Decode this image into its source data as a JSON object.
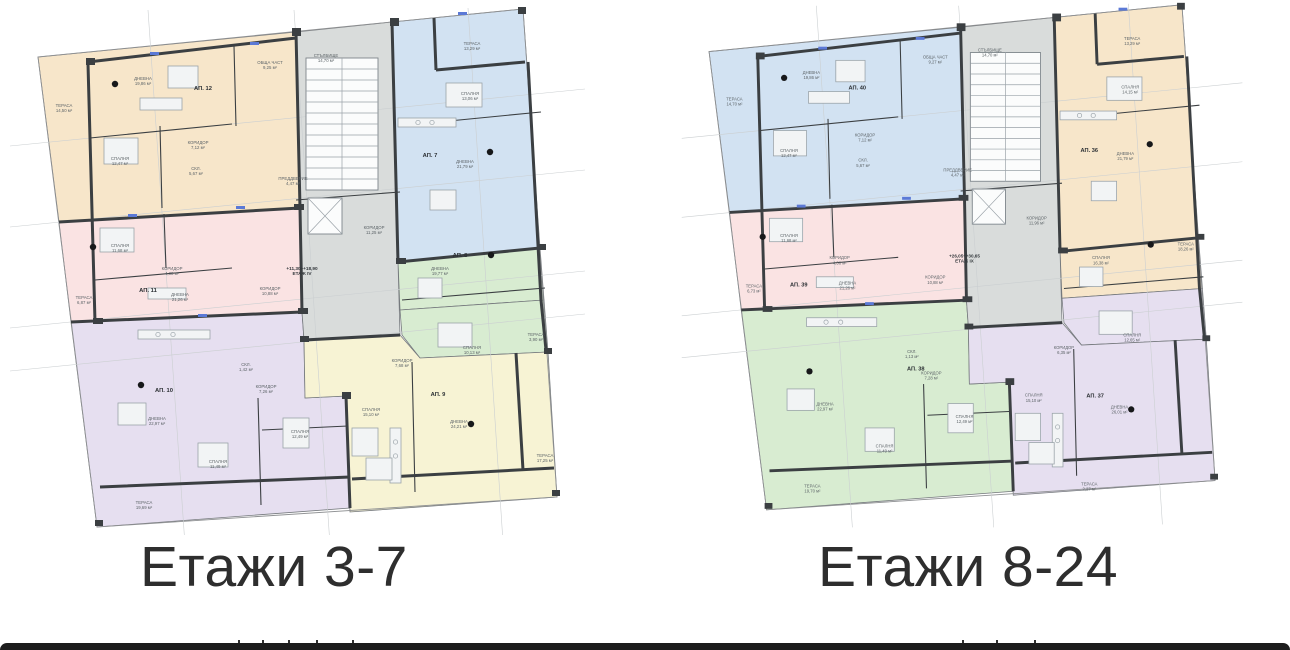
{
  "colors": {
    "orange": "#f7e6ca",
    "blue": "#d2e2f2",
    "pink": "#fae3e3",
    "green": "#d8ecd1",
    "lavender": "#e6dff0",
    "yellow": "#f7f3d4",
    "core": "#d9dcdb",
    "wall": "#3b3f42",
    "outline": "#8f9193",
    "bottom_bar": "#1d1d1d"
  },
  "plans": [
    {
      "caption": "Етажи 3-7",
      "zones": {
        "TL": "orange",
        "TR": "blue",
        "ML": "pink",
        "MRu": "green",
        "MRl": "green",
        "BL": "lavender",
        "BR": "yellow"
      },
      "level": {
        "elevation": "+11,30÷+18,90",
        "floor": "ЕТАЖ IV",
        "x": 302,
        "y": 270
      },
      "apartments": [
        {
          "label": "АП. 12",
          "x": 203,
          "y": 90
        },
        {
          "label": "АП. 7",
          "x": 430,
          "y": 157
        },
        {
          "label": "АП. 11",
          "x": 148,
          "y": 292
        },
        {
          "label": "АП. 8",
          "x": 460,
          "y": 257
        },
        {
          "label": "АП. 10",
          "x": 164,
          "y": 392
        },
        {
          "label": "АП. 9",
          "x": 438,
          "y": 396
        }
      ],
      "rooms": [
        {
          "name": "ТЕРАСА",
          "area": "14,50 м²",
          "x": 64,
          "y": 107
        },
        {
          "name": "ДНЕВНА",
          "area": "19,86 м²",
          "x": 143,
          "y": 80
        },
        {
          "name": "СПАЛНЯ",
          "area": "12,47 м²",
          "x": 120,
          "y": 160
        },
        {
          "name": "КОРИДОР",
          "area": "7,12 м²",
          "x": 198,
          "y": 144
        },
        {
          "name": "СКЛ.",
          "area": "5,67 м²",
          "x": 196,
          "y": 170
        },
        {
          "name": "ТЕРАСА",
          "area": "13,29 м²",
          "x": 472,
          "y": 45
        },
        {
          "name": "СПАЛНЯ",
          "area": "13,06 м²",
          "x": 470,
          "y": 95
        },
        {
          "name": "ДНЕВНА",
          "area": "21,79 м²",
          "x": 465,
          "y": 163
        },
        {
          "name": "КОРИДОР",
          "area": "11,25 м²",
          "x": 374,
          "y": 229
        },
        {
          "name": "ТЕРАСА",
          "area": "6,87 м²",
          "x": 84,
          "y": 299
        },
        {
          "name": "СПАЛНЯ",
          "area": "11,68 м²",
          "x": 120,
          "y": 247
        },
        {
          "name": "ДНЕВНА",
          "area": "21,26 м²",
          "x": 180,
          "y": 296
        },
        {
          "name": "КОРИДОР",
          "area": "4,38 м²",
          "x": 172,
          "y": 270
        },
        {
          "name": "ДНЕВНА",
          "area": "19,77 м²",
          "x": 440,
          "y": 270
        },
        {
          "name": "СПАЛНЯ",
          "area": "10,13 м²",
          "x": 472,
          "y": 349
        },
        {
          "name": "ТЕРАСА",
          "area": "3,90 м²",
          "x": 536,
          "y": 336
        },
        {
          "name": "ДНЕВНА",
          "area": "22,97 м²",
          "x": 157,
          "y": 420
        },
        {
          "name": "СПАЛНЯ",
          "area": "11,49 м²",
          "x": 218,
          "y": 463
        },
        {
          "name": "СПАЛНЯ",
          "area": "12,49 м²",
          "x": 300,
          "y": 433
        },
        {
          "name": "ТЕРАСА",
          "area": "19,69 м²",
          "x": 144,
          "y": 504
        },
        {
          "name": "КОРИДОР",
          "area": "7,26 м²",
          "x": 266,
          "y": 388
        },
        {
          "name": "СКЛ.",
          "area": "1,42 м²",
          "x": 246,
          "y": 366
        },
        {
          "name": "ДНЕВНА",
          "area": "24,21 м²",
          "x": 459,
          "y": 423
        },
        {
          "name": "СПАЛНЯ",
          "area": "15,10 м²",
          "x": 371,
          "y": 411
        },
        {
          "name": "ТЕРАСА",
          "area": "17,25 м²",
          "x": 545,
          "y": 457
        },
        {
          "name": "КОРИДОР",
          "area": "7,68 м²",
          "x": 402,
          "y": 362
        }
      ],
      "core_labels": [
        {
          "name": "ОБЩА ЧАСТ",
          "area": "9,25 м²",
          "x": 270,
          "y": 64
        },
        {
          "name": "СТЪЛБИЩЕ",
          "area": "14,70 м²",
          "x": 326,
          "y": 57
        },
        {
          "name": "ПРЕДДВЕРИЕ",
          "area": "4,47 м²",
          "x": 293,
          "y": 180
        },
        {
          "name": "КОРИДОР",
          "area": "10,88 м²",
          "x": 270,
          "y": 290
        }
      ]
    },
    {
      "caption": "Етажи 8-24",
      "zones": {
        "TL": "blue",
        "TR": "orange",
        "ML": "pink",
        "MRu": "orange",
        "MRl": "lavender",
        "BL": "green",
        "BR": "lavender"
      },
      "level": {
        "elevation": "+26,05÷+30,65",
        "floor": "ЕТАЖ IX",
        "x": 300,
        "y": 268
      },
      "apartments": [
        {
          "label": "АП. 40",
          "x": 190,
          "y": 96
        },
        {
          "label": "АП. 36",
          "x": 428,
          "y": 160
        },
        {
          "label": "АП. 39",
          "x": 130,
          "y": 298
        },
        {
          "label": "АП. 38",
          "x": 250,
          "y": 384
        },
        {
          "label": "АП. 37",
          "x": 434,
          "y": 412
        }
      ],
      "rooms": [
        {
          "name": "ТЕРАСА",
          "area": "14,70 м²",
          "x": 64,
          "y": 107
        },
        {
          "name": "ДНЕВНА",
          "area": "19,86 м²",
          "x": 143,
          "y": 80
        },
        {
          "name": "СПАЛНЯ",
          "area": "12,47 м²",
          "x": 120,
          "y": 160
        },
        {
          "name": "КОРИДОР",
          "area": "7,12 м²",
          "x": 198,
          "y": 144
        },
        {
          "name": "СКЛ.",
          "area": "5,67 м²",
          "x": 196,
          "y": 170
        },
        {
          "name": "ТЕРАСА",
          "area": "13,29 м²",
          "x": 472,
          "y": 45
        },
        {
          "name": "СПАЛНЯ",
          "area": "14,15 м²",
          "x": 470,
          "y": 95
        },
        {
          "name": "ДНЕВНА",
          "area": "21,79 м²",
          "x": 465,
          "y": 163
        },
        {
          "name": "КОРИДОР",
          "area": "11,96 м²",
          "x": 374,
          "y": 229
        },
        {
          "name": "ТЕРАСА",
          "area": "6,73 м²",
          "x": 84,
          "y": 299
        },
        {
          "name": "СПАЛНЯ",
          "area": "11,68 м²",
          "x": 120,
          "y": 247
        },
        {
          "name": "ДНЕВНА",
          "area": "21,26 м²",
          "x": 180,
          "y": 296
        },
        {
          "name": "КОРИДОР",
          "area": "4,38 м²",
          "x": 172,
          "y": 270
        },
        {
          "name": "СПАЛНЯ",
          "area": "16,38 м²",
          "x": 440,
          "y": 270
        },
        {
          "name": "СПАЛНЯ",
          "area": "12,65 м²",
          "x": 472,
          "y": 349
        },
        {
          "name": "ТЕРАСА",
          "area": "18,26 м²",
          "x": 527,
          "y": 256
        },
        {
          "name": "ДНЕВНА",
          "area": "22,97 м²",
          "x": 157,
          "y": 420
        },
        {
          "name": "СПАЛНЯ",
          "area": "11,49 м²",
          "x": 218,
          "y": 463
        },
        {
          "name": "СПАЛНЯ",
          "area": "12,49 м²",
          "x": 300,
          "y": 433
        },
        {
          "name": "ТЕРАСА",
          "area": "19,70 м²",
          "x": 144,
          "y": 504
        },
        {
          "name": "КОРИДОР",
          "area": "7,28 м²",
          "x": 266,
          "y": 388
        },
        {
          "name": "СКЛ.",
          "area": "1,13 м²",
          "x": 246,
          "y": 366
        },
        {
          "name": "ДНЕВНА",
          "area": "26,01 м²",
          "x": 459,
          "y": 423
        },
        {
          "name": "СПАЛНЯ",
          "area": "15,10 м²",
          "x": 371,
          "y": 411
        },
        {
          "name": "ТЕРАСА",
          "area": "2,27 м²",
          "x": 428,
          "y": 502
        },
        {
          "name": "КОРИДОР",
          "area": "6,35 м²",
          "x": 402,
          "y": 362
        }
      ],
      "core_labels": [
        {
          "name": "ОБЩА ЧАСТ",
          "area": "9,27 м²",
          "x": 270,
          "y": 64
        },
        {
          "name": "СТЪЛБИЩЕ",
          "area": "14,70 м²",
          "x": 326,
          "y": 57
        },
        {
          "name": "ПРЕДДВЕРИЕ",
          "area": "4,47 м²",
          "x": 293,
          "y": 180
        },
        {
          "name": "КОРИДОР",
          "area": "10,88 м²",
          "x": 270,
          "y": 290
        }
      ]
    }
  ]
}
